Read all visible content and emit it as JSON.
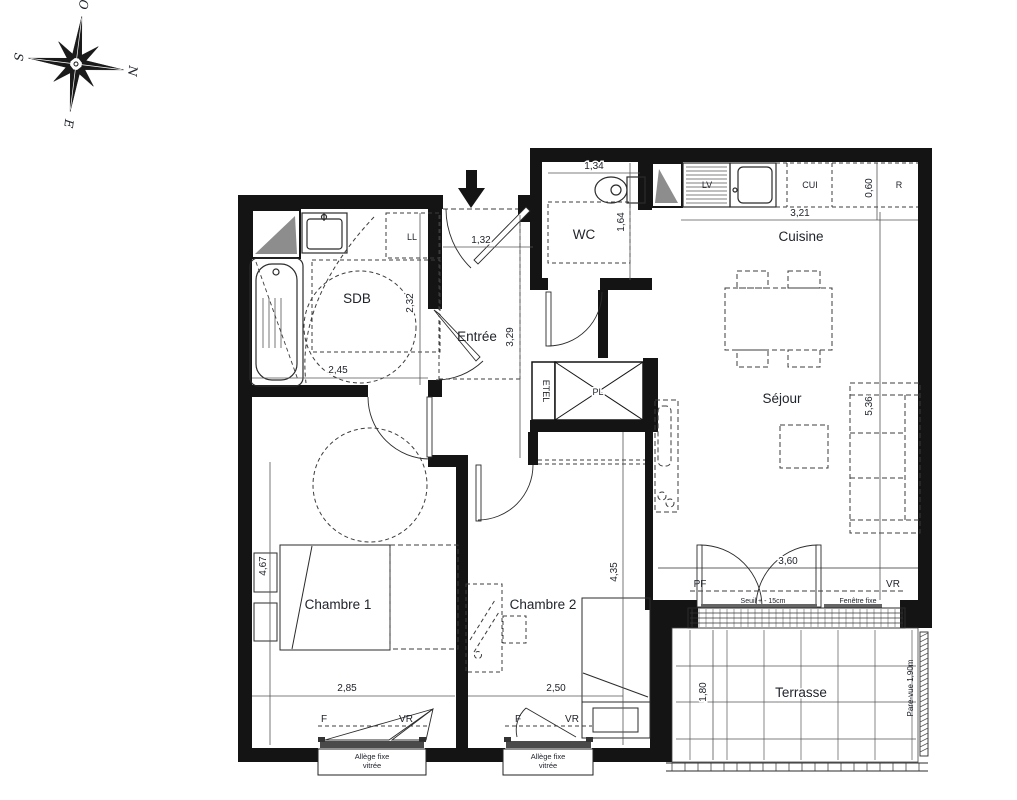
{
  "colors": {
    "wall": "#141414",
    "line": "#2b2b2b",
    "dashed": "#3c3c3c",
    "gray": "#8d8d8d",
    "text": "#20242c",
    "sill": "#4a4a4a"
  },
  "compass": {
    "o": "O",
    "n": "N",
    "s": "S",
    "e": "E"
  },
  "rooms": {
    "wc": "WC",
    "cuisine": "Cuisine",
    "sdb": "SDB",
    "entree": "Entrée",
    "sejour": "Séjour",
    "chambre1": "Chambre 1",
    "chambre2": "Chambre 2",
    "terrasse": "Terrasse"
  },
  "closets": {
    "pl": "PL",
    "etel": "ETEL"
  },
  "appliances": {
    "washer": "LL",
    "dishwasher": "LV",
    "cooker": "CUI",
    "fridge": "R"
  },
  "dimensions": {
    "wc_w": "1,34",
    "wc_h": "1,64",
    "kitchen_w": "3,21",
    "counter_d": "0,60",
    "sdb_w": "2,45",
    "sdb_h": "2,32",
    "entree_w": "1,32",
    "entree_h": "3,29",
    "sejour_h": "5,36",
    "bay_w": "3,60",
    "ch1_h": "4,67",
    "ch1_w": "2,85",
    "ch2_h": "4,35",
    "ch2_w": "2,50",
    "terrasse_d": "1,80"
  },
  "openings": {
    "pf": "PF",
    "vr": "VR",
    "f": "F",
    "seuil": "Seuil + - 15cm",
    "fixed": "Fenêtre fixe",
    "allege_1": "Allège fixe",
    "allege_2": "vitrée",
    "parevue": "Pare-vue 1,90m"
  }
}
